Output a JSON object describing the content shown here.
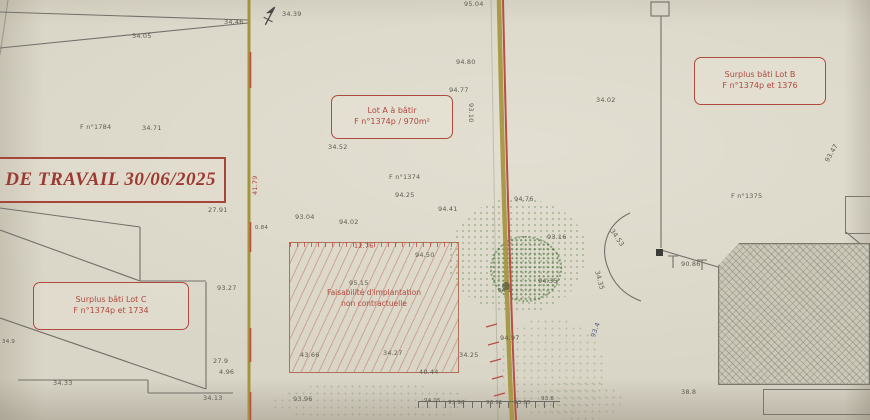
{
  "title": {
    "text": "DE TRAVAIL 30/06/2025"
  },
  "boxes": {
    "lot_a": {
      "line1": "Lot A à bâtir",
      "line2": "F n°1374p / 970m²"
    },
    "lot_b": {
      "line1": "Surplus bâti Lot B",
      "line2": "F n°1374p et 1376"
    },
    "lot_c": {
      "line1": "Surplus bâti Lot C",
      "line2": "F n°1374p et 1734"
    }
  },
  "hatch_area": {
    "line1": "Faisabilité d'implantation",
    "line2": "non contractuelle"
  },
  "colors": {
    "paper": "#dad6c7",
    "annotation_red": "#b0493f",
    "boundary_olive": "#a3943c",
    "road_red": "#b84f45",
    "vegetation_green": "#6c8a58",
    "line_gray": "#72706a"
  },
  "labels": [
    {
      "t": "34.05"
    },
    {
      "t": "34.46"
    },
    {
      "t": "34.39"
    },
    {
      "t": "F n°1784"
    },
    {
      "t": "34.71"
    },
    {
      "t": "95.04"
    },
    {
      "t": "94.80"
    },
    {
      "t": "94.77"
    },
    {
      "t": "93.10"
    },
    {
      "t": "34.52"
    },
    {
      "t": "F n°1374"
    },
    {
      "t": "94.25"
    },
    {
      "t": "94.41"
    },
    {
      "t": "93.04"
    },
    {
      "t": "94.02"
    },
    {
      "t": "0.84"
    },
    {
      "t": "12.76"
    },
    {
      "t": "94.50"
    },
    {
      "t": "95.15"
    },
    {
      "t": "43.66"
    },
    {
      "t": "34.27"
    },
    {
      "t": "40.44"
    },
    {
      "t": "93.96"
    },
    {
      "t": "34.33"
    },
    {
      "t": "27.91"
    },
    {
      "t": "93.27"
    },
    {
      "t": "27.9"
    },
    {
      "t": "4.96"
    },
    {
      "t": "34.13"
    },
    {
      "t": "34.9"
    },
    {
      "t": "41.79"
    },
    {
      "t": "94.76"
    },
    {
      "t": "93.16"
    },
    {
      "t": "94.35"
    },
    {
      "t": "94.1"
    },
    {
      "t": "34.25"
    },
    {
      "t": "94.97"
    },
    {
      "t": "94.05"
    },
    {
      "t": "93.98"
    },
    {
      "t": "93.91"
    },
    {
      "t": "93.85"
    },
    {
      "t": "93.8"
    },
    {
      "t": "93.4"
    },
    {
      "t": "34.02"
    },
    {
      "t": "F n°1375"
    },
    {
      "t": "34.53"
    },
    {
      "t": "34.35"
    },
    {
      "t": "90.86"
    },
    {
      "t": "93.47"
    },
    {
      "t": "38.8"
    }
  ]
}
